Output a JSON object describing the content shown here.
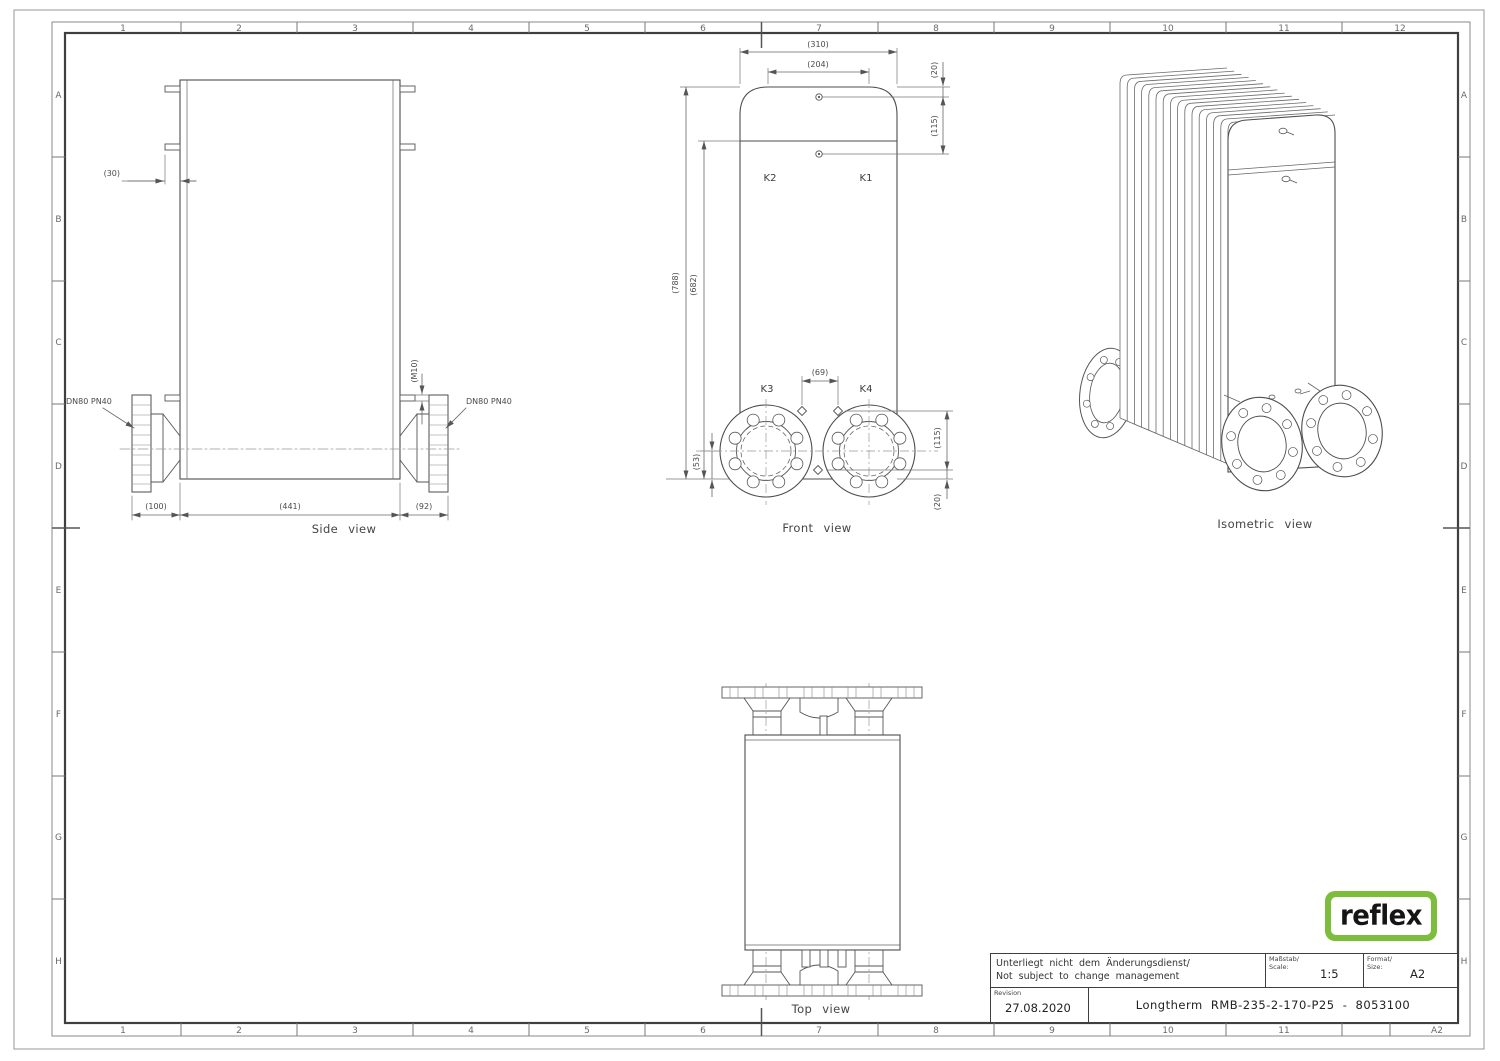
{
  "frame": {
    "top": [
      "1",
      "2",
      "3",
      "4",
      "5",
      "6",
      "7",
      "8",
      "9",
      "10",
      "11",
      "12"
    ],
    "bottom": [
      "1",
      "2",
      "3",
      "4",
      "5",
      "6",
      "7",
      "8",
      "9",
      "10",
      "11"
    ],
    "bottom_right": "A2",
    "left": [
      "A",
      "B",
      "C",
      "D",
      "E",
      "F",
      "G",
      "H"
    ],
    "right": [
      "A",
      "B",
      "C",
      "D",
      "E",
      "F",
      "G",
      "H"
    ]
  },
  "views": {
    "side": {
      "title": "Side view",
      "dim_30": "(30)",
      "dim_m10": "(M10)",
      "flange_left": "DN80 PN40",
      "flange_right": "DN80 PN40",
      "dim_100": "(100)",
      "dim_441": "(441)",
      "dim_92": "(92)"
    },
    "front": {
      "title": "Front view",
      "dim_310": "(310)",
      "dim_204": "(204)",
      "dim_20_top": "(20)",
      "dim_115_top": "(115)",
      "dim_788": "(788)",
      "dim_682": "(682)",
      "dim_69": "(69)",
      "dim_53": "(53)",
      "dim_115_bottom": "(115)",
      "dim_20_bottom": "(20)",
      "port_k1": "K1",
      "port_k2": "K2",
      "port_k3": "K3",
      "port_k4": "K4"
    },
    "top": {
      "title": "Top view"
    },
    "iso": {
      "title": "Isometric view"
    }
  },
  "title_block": {
    "note_line1": "Unterliegt nicht dem Änderungsdienst/",
    "note_line2": "Not subject to change management",
    "scale_label_de": "Maßstab/",
    "scale_label_en": "Scale:",
    "scale_value": "1:5",
    "format_label_de": "Format/",
    "format_label_en": "Size:",
    "format_value": "A2",
    "revision_label": "Revision",
    "revision_value": "27.08.2020",
    "drawing_title": "Longtherm RMB-235-2-170-P25 - 8053100"
  },
  "logo": {
    "text": "reflex",
    "green": "#7cbd3c"
  },
  "colors": {
    "line": "#4d4d4d",
    "dim_line": "#6a6a6a",
    "frame": "#3f3f3f"
  }
}
